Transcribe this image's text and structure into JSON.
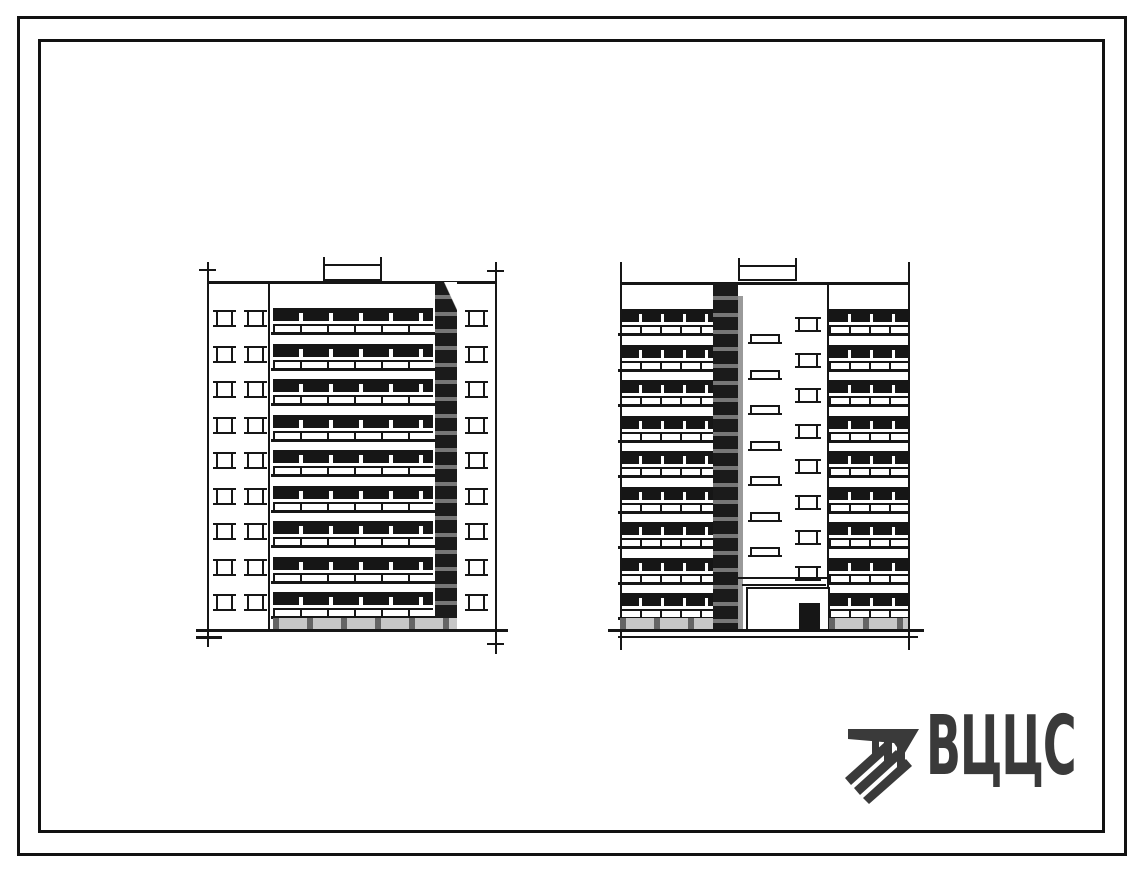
{
  "sheet": {
    "kind": "scanned standard-design elevation sheet",
    "paper_color": "#ffffff",
    "ink_color": "#161616",
    "border_color": "#121212"
  },
  "drawing": {
    "left_elevation": {
      "floors": 9,
      "left_window_columns": 2,
      "right_window_columns": 1
    },
    "right_elevation": {
      "floors": 9,
      "stair_landing_windows": 7,
      "core_windows": 8
    }
  },
  "logo": {
    "text": "ВЦЦС",
    "color": "#3a3a3a"
  }
}
